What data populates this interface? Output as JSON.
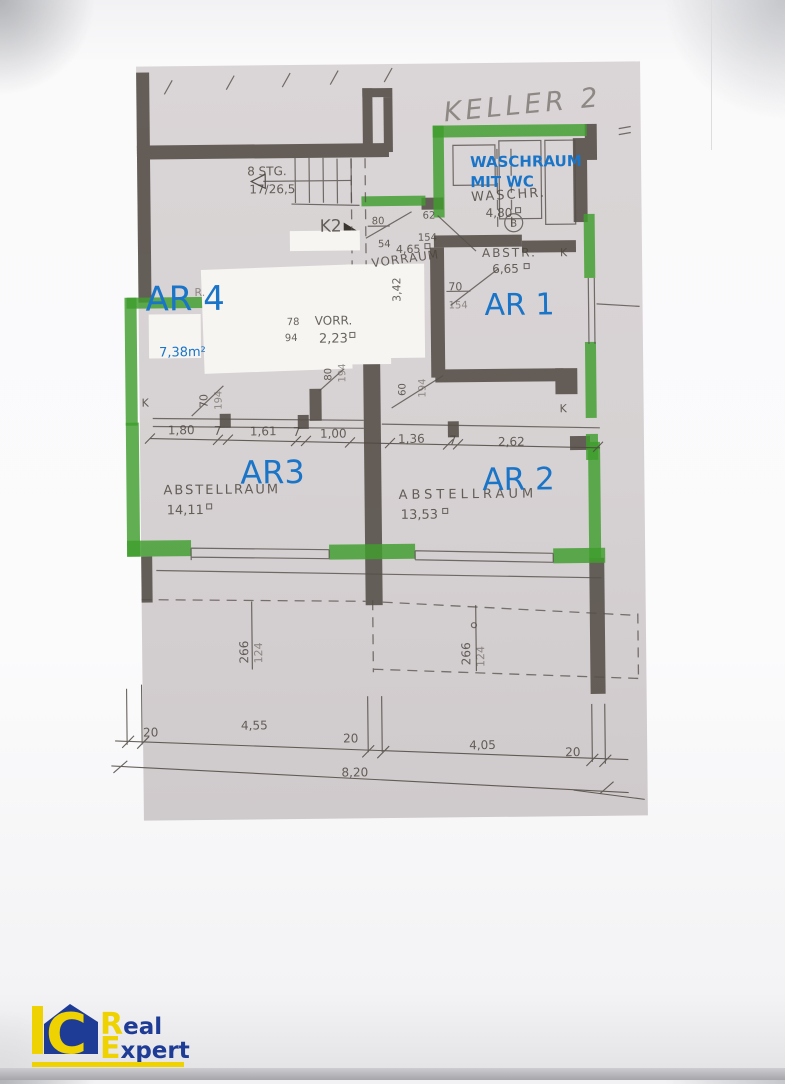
{
  "plan": {
    "handwritten_title": "KELLER 2",
    "stairs": {
      "label": "8 STG.",
      "ratio": "17/26,5"
    },
    "rooms": {
      "vorraum_top": {
        "name": "VORRAUM",
        "height_dim": "3,42"
      },
      "vorr": {
        "name": "VORR.",
        "area": "2,23"
      },
      "waschraum": {
        "name": "WASCHR.",
        "area": "4,80",
        "circle_mark": "B"
      },
      "abstr": {
        "name": "ABSTR.",
        "area": "6,65"
      },
      "abstellraum_left": {
        "name": "ABSTELLRAUM",
        "area": "14,11"
      },
      "abstellraum_right": {
        "name": "ABSTELLRAUM",
        "area": "13,53"
      },
      "hidden_label_fragment": "R."
    },
    "k_marks": {
      "k2": "K2",
      "left": "K",
      "right_top": "K",
      "right_bottom": "K"
    },
    "dims": {
      "door_62": "62",
      "k2_80": "80",
      "k2_154": "154",
      "k2_54": "54",
      "k2_465": "4,65",
      "abstr_70": "70",
      "abstr_154": "154",
      "vorr_78": "78",
      "vorr_94": "94",
      "pier_left_70": "70",
      "pier_left_194": "194",
      "pier_mid_80": "80",
      "pier_mid_194": "194",
      "pier_right_60": "60",
      "pier_right_194": "194",
      "chain_top": [
        "1,80",
        "7",
        "1,61",
        "7",
        "1,00",
        "1,36",
        "7",
        "2,62"
      ],
      "vert_left_266": "266",
      "vert_left_124": "124",
      "vert_right_266": "266",
      "vert_right_124": "124",
      "chain_bottom": [
        "20",
        "4,55",
        "20",
        "4,05",
        "20"
      ],
      "total_width": "8,20"
    }
  },
  "annotations": {
    "color": "#1a75c8",
    "waschraum_line1": "WASCHRAUM",
    "waschraum_line2": "MIT WC",
    "ar1": "AR 1",
    "ar2": "AR 2",
    "ar3": "AR3",
    "ar4": "AR 4",
    "ar4_area": "7,38m²"
  },
  "highlights": {
    "wall_color": "#3f9e2d"
  },
  "logo": {
    "i": "I",
    "c": "C",
    "word1_initial": "R",
    "word1_rest": "eal",
    "word2_initial": "E",
    "word2_rest": "xpert",
    "blue": "#1e3c96",
    "yellow": "#eed202"
  }
}
